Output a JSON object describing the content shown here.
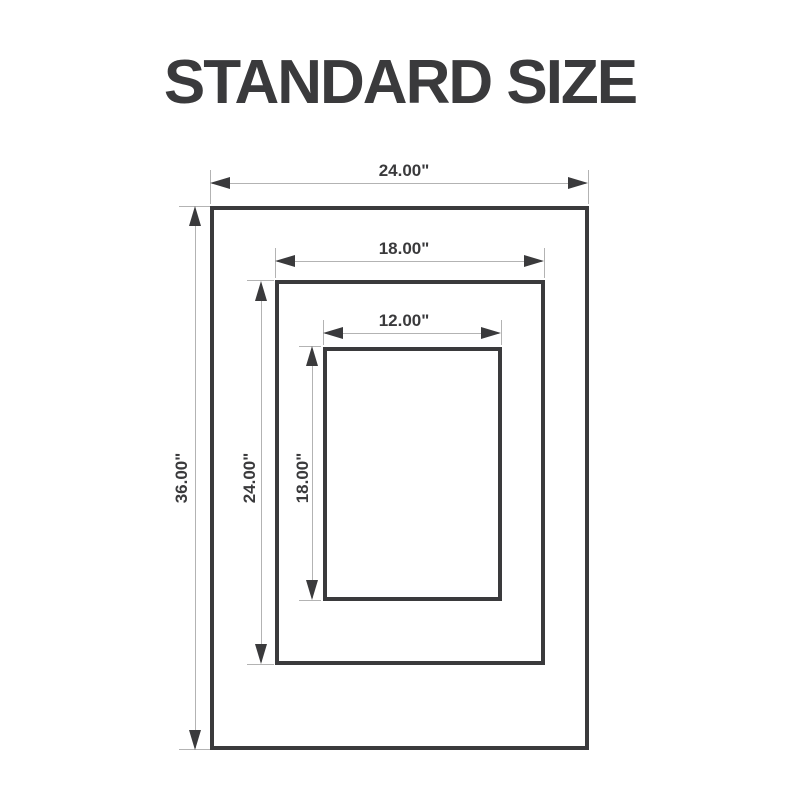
{
  "title": "STANDARD SIZE",
  "colors": {
    "ink": "#3a3a3c",
    "dim_line": "#b3b3b3",
    "background": "#ffffff"
  },
  "frames": [
    {
      "name": "outer",
      "width_label": "24.00\"",
      "height_label": "36.00\""
    },
    {
      "name": "middle",
      "width_label": "18.00\"",
      "height_label": "24.00\""
    },
    {
      "name": "inner",
      "width_label": "12.00\"",
      "height_label": "18.00\""
    }
  ]
}
